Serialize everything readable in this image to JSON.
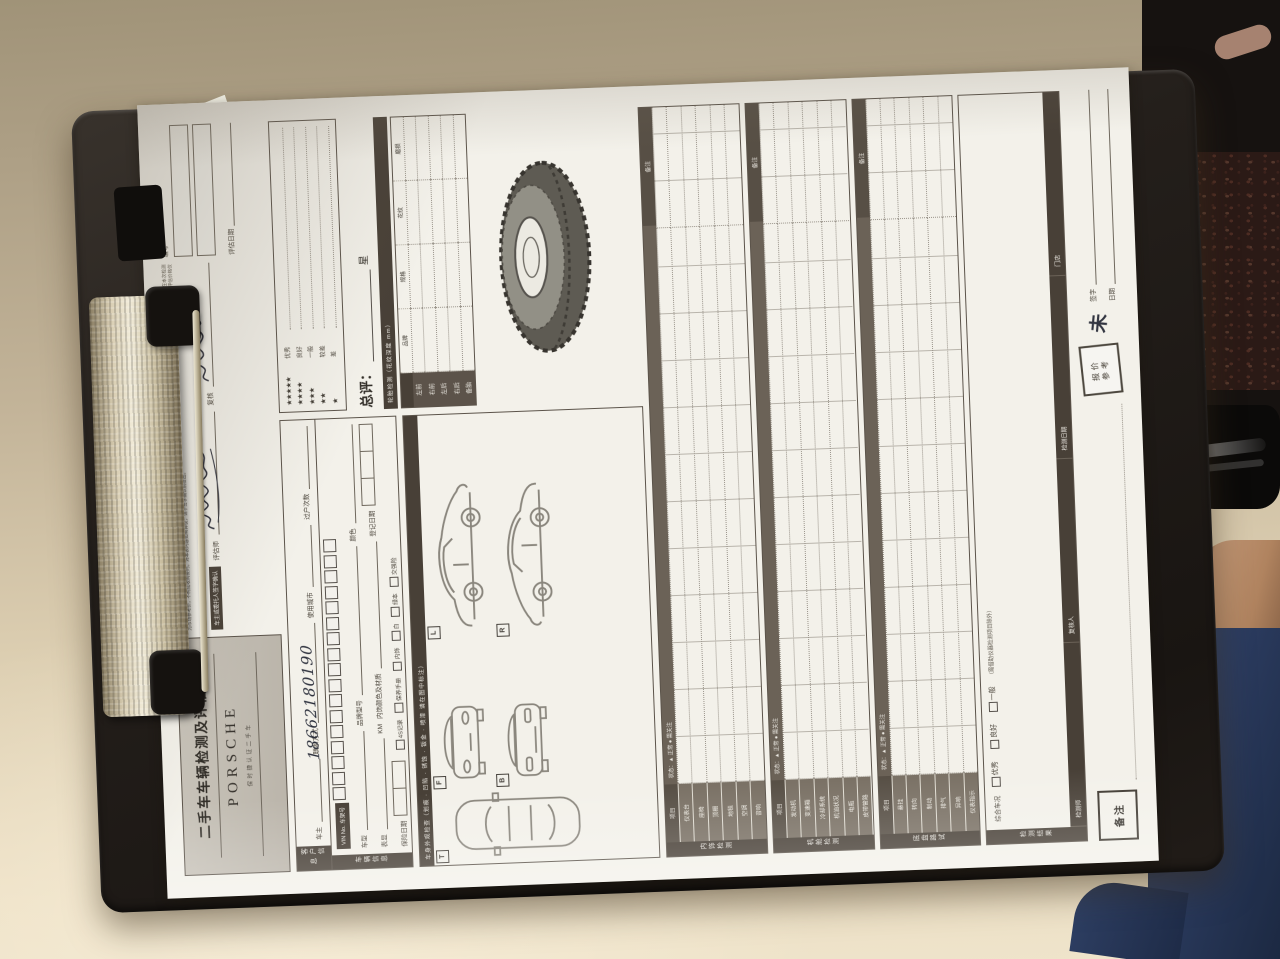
{
  "header": {
    "title": "二手车车辆检测及评估表",
    "brand": "PORSCHE",
    "brand_sub": "保时捷认证二手车",
    "disclaimer": "本检测评估表所载内容仅反映检测当日车辆之外观及功能状况，不构成对车辆质量的任何担保或承诺。受检测条件所限，隐蔽部位、不可拆解部位及电子系统内部状况不在本次检测范围之内。车主或委托人应如实告知车辆的事故、维修、泡水及过户等记录，因隐瞒或告知不实所产生的一切后果由车主承担。本表一式两份，经双方签字确认后生效。评估价格仅为市场参考价，不构成收购要约。对本表内容如有异议，请于签字确认前提出。",
    "confirm_label": "车主或委托人签字确认",
    "assessor_label": "评估师",
    "review_label": "复核",
    "no_label": "编号",
    "date_label": "评估日期"
  },
  "customer": {
    "band": "客户信息",
    "owner_label": "车主",
    "phone_label": "联系方式",
    "phone_value": "18662180190",
    "city_label": "使用城市",
    "transfer_label": "过户次数"
  },
  "vehicle": {
    "band": "车辆信息",
    "vin_label": "VIN No. 车架号",
    "vin_boxes": [
      "",
      "",
      "",
      "",
      "",
      "",
      "",
      "",
      "",
      "",
      "",
      "",
      "",
      "",
      "",
      "",
      ""
    ],
    "model_label": "车型",
    "brand_model_label": "品牌型号",
    "color_label": "颜色",
    "odo_label": "表显",
    "odo_unit": "KM",
    "interior_label": "内饰颜色及材质",
    "reg_label": "登记日期",
    "ins_label": "保险日期",
    "checks": [
      "4S记录",
      "保养手册",
      "内饰",
      "白",
      "绿本",
      "交强险"
    ]
  },
  "rating": {
    "legend": [
      {
        "stars": "★★★★★",
        "text": "优秀"
      },
      {
        "stars": "★★★★",
        "text": "良好"
      },
      {
        "stars": "★★★",
        "text": "一般"
      },
      {
        "stars": "★★",
        "text": "较差"
      },
      {
        "stars": "★",
        "text": "差"
      }
    ],
    "overall_label": "总评：",
    "overall_unit": "星"
  },
  "tire": {
    "band": "轮胎检测（花纹深度 mm）",
    "cols": [
      "品牌",
      "规格",
      "花纹",
      "磨损"
    ],
    "rows": [
      {
        "label": "左前"
      },
      {
        "label": "右前"
      },
      {
        "label": "左后"
      },
      {
        "label": "右后"
      },
      {
        "label": "备胎"
      }
    ]
  },
  "exterior": {
    "band": "车身外观检查（划痕 · 凹陷 · 锈蚀 · 钣金 · 喷漆 请在图中标注）",
    "tags": [
      "T",
      "F",
      "B",
      "L",
      "R"
    ]
  },
  "sections": [
    {
      "title": "内饰检测",
      "item_head": "项目",
      "status_head": "状态：▲ 正常 ● 需关注",
      "note_head": "备注",
      "rows": [
        {
          "label": "仪表台"
        },
        {
          "label": "座椅"
        },
        {
          "label": "顶棚"
        },
        {
          "label": "地毯"
        },
        {
          "label": "空调"
        },
        {
          "label": "音响"
        }
      ]
    },
    {
      "title": "机舱检测",
      "item_head": "项目",
      "status_head": "状态：▲ 正常 ● 需关注",
      "note_head": "备注",
      "rows": [
        {
          "label": "发动机"
        },
        {
          "label": "变速箱"
        },
        {
          "label": "冷却系统"
        },
        {
          "label": "机油状况"
        },
        {
          "label": "电瓶"
        },
        {
          "label": "皮带管路"
        }
      ]
    },
    {
      "title": "底盘路试",
      "item_head": "项目",
      "status_head": "状态：▲ 正常 ● 需关注",
      "note_head": "备注",
      "rows": [
        {
          "label": "悬挂"
        },
        {
          "label": "转向"
        },
        {
          "label": "制动"
        },
        {
          "label": "排气"
        },
        {
          "label": "异响"
        },
        {
          "label": "仪表指示"
        }
      ]
    },
    {
      "title": "检测结果",
      "cond_label": "综合车况",
      "options": [
        "优秀",
        "良好",
        "一般"
      ],
      "note": "（需借助仪器检测项目除外）",
      "footer": [
        {
          "label": "检测师"
        },
        {
          "label": "复核人"
        },
        {
          "label": "检测日期"
        },
        {
          "label": "门店"
        }
      ]
    }
  ],
  "footer": {
    "remark_label": "备注",
    "stamp_line1": "报价",
    "stamp_line2": "参考",
    "handwritten_mark": "未",
    "sign_label": "签字",
    "date_label": "日期"
  }
}
